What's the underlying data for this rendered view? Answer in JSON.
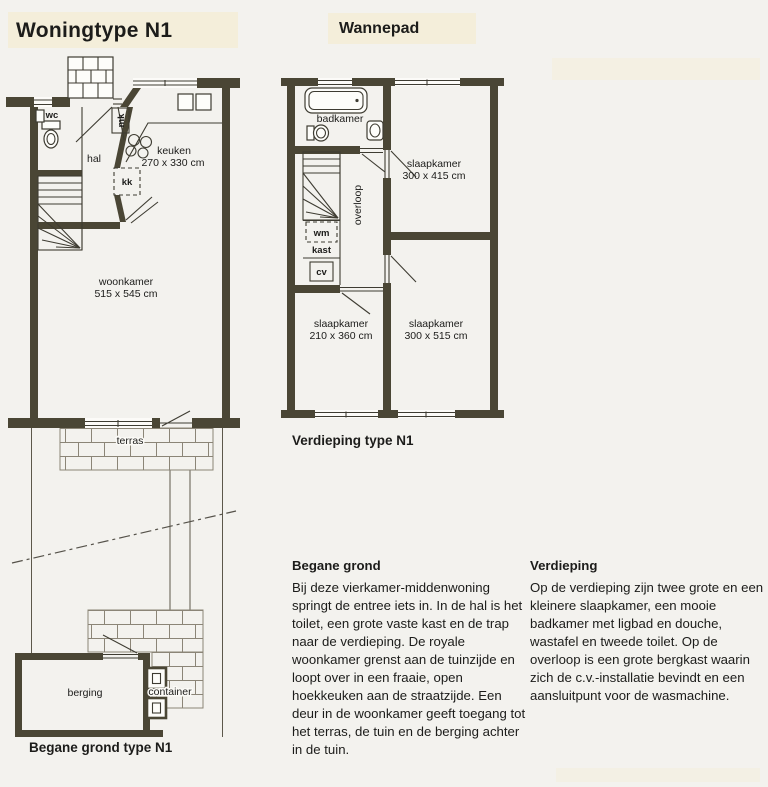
{
  "page": {
    "title": "Woningtype N1",
    "project": "Wannepad"
  },
  "ground_floor": {
    "caption": "Begane grond type N1",
    "labels": {
      "wc": "wc",
      "hal": "hal",
      "mk": "mk",
      "kk": "kk",
      "keuken_name": "keuken",
      "keuken_dims": "270 x 330 cm",
      "woonkamer_name": "woonkamer",
      "woonkamer_dims": "515 x 545 cm",
      "terras": "terras",
      "berging": "berging",
      "container": "container"
    }
  },
  "upper_floor": {
    "caption": "Verdieping type N1",
    "labels": {
      "badkamer": "badkamer",
      "overloop": "overloop",
      "wm": "wm",
      "kast": "kast",
      "cv": "cv",
      "slaapkamer1_name": "slaapkamer",
      "slaapkamer1_dims": "300 x 415 cm",
      "slaapkamer2_name": "slaapkamer",
      "slaapkamer2_dims": "210 x 360 cm",
      "slaapkamer3_name": "slaapkamer",
      "slaapkamer3_dims": "300 x 515 cm"
    }
  },
  "descriptions": {
    "ground": {
      "heading": "Begane grond",
      "body": "Bij deze vierkamer-middenwoning springt de entree iets in. In de hal is het toilet, een grote vaste kast en de trap naar de verdieping. De royale woonkamer grenst aan de tuinzijde en loopt over in een fraaie, open hoekkeuken aan de straatzijde. Een deur in de woonkamer geeft toegang tot het terras, de tuin en de berging achter in de tuin."
    },
    "upper": {
      "heading": "Verdieping",
      "body": "Op de verdieping zijn twee grote en een kleinere slaapkamer, een mooie badkamer met ligbad en douche, wastafel en tweede toilet. Op de overloop is een grote bergkast waarin zich de c.v.-installatie bevindt en een aansluitpunt voor de wasmachine."
    }
  },
  "colors": {
    "wall": "#4a4635",
    "line": "#3e3c32",
    "brick": "#8b8577",
    "paper": "#f3f2ee",
    "highlight": "#f4eeda",
    "text": "#1c1c1a"
  }
}
